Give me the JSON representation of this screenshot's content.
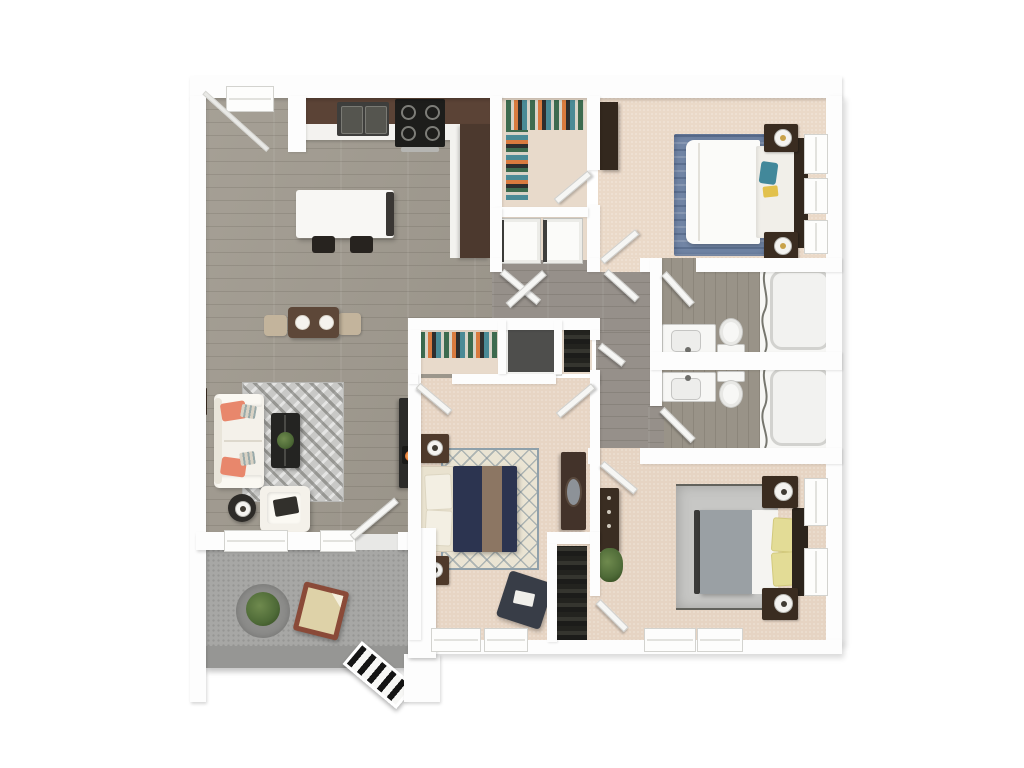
{
  "scene": {
    "type": "3d-floorplan-top-down-render",
    "description": "Top-down 3D rendering of an apartment floor plan on a plain white background. Open living/dining/kitchen with gray plank flooring, walk-in closet and laundry nook, three carpeted bedrooms, two mirrored bathrooms, and a concrete patio with exterior stairs.",
    "background": "plain white, no text or labels visible"
  },
  "rooms": [
    {
      "name": "entry",
      "features": [
        "entry-door",
        "sidelight-window"
      ]
    },
    {
      "name": "kitchen",
      "features": [
        "l-shaped-dark-brown-counter",
        "double-basin-sink",
        "black-stove-with-burners",
        "white-island",
        "two-bar-stools",
        "tall-cabinet-run"
      ]
    },
    {
      "name": "living-dining-area",
      "features": [
        "white-sofa-with-coral-pillows",
        "chevron-area-rug",
        "dark-coffee-table-with-plant",
        "round-side-table-with-lamp",
        "white-armchair-with-tray",
        "media-console-with-fireplace",
        "picture-frame",
        "dining-table-with-two-plates",
        "two-tan-dining-chairs",
        "two-windows"
      ]
    },
    {
      "name": "walk-in-closet",
      "features": [
        "hanging-clothes",
        "door-to-bedroom-1"
      ]
    },
    {
      "name": "laundry-nook",
      "features": [
        "washer",
        "dryer",
        "double-doors-to-hallway"
      ]
    },
    {
      "name": "bedroom-1",
      "features": [
        "white-bed",
        "blue-area-rug",
        "dark-headboard",
        "two-nightstands-with-lamps",
        "teal-and-yellow-accent-pillows",
        "wardrobe",
        "three-windows"
      ]
    },
    {
      "name": "hallway",
      "features": [
        "open-doors",
        "linen-closet-dark",
        "coat-closet-clothes",
        "small-closet-door"
      ]
    },
    {
      "name": "bathroom-upper",
      "features": [
        "vanity-with-sink",
        "toilet",
        "bathtub",
        "shower-curtain",
        "door"
      ]
    },
    {
      "name": "bathroom-lower",
      "features": [
        "vanity-with-sink",
        "toilet",
        "bathtub",
        "shower-curtain",
        "door"
      ]
    },
    {
      "name": "bedroom-2",
      "features": [
        "navy-bed-with-taupe-throw",
        "cream-headboard-with-pillows",
        "diamond-lattice-rug",
        "two-nightstands-with-lamps",
        "dresser-with-oval-mirror",
        "navy-ottoman-with-book",
        "closet-with-clothes-row",
        "two-windows"
      ]
    },
    {
      "name": "bedroom-3",
      "features": [
        "gray-and-white-bed-with-yellow-pillows",
        "gray-bordered-rug",
        "dark-headboard",
        "two-nightstands-with-lamps",
        "dresser",
        "floor-plant",
        "reach-in-closet-dark-clothes",
        "four-windows"
      ]
    },
    {
      "name": "patio",
      "features": [
        "round-gray-rug",
        "potted-plant",
        "wood-frame-lounge-chair",
        "concrete-parapet",
        "exterior-stairs",
        "landing"
      ]
    }
  ],
  "colors": {
    "page_bg": "#ffffff",
    "wall": "#fdfdfd",
    "wood": "#a19b90",
    "hall_wood": "#96908a",
    "bath_wood": "#999388",
    "carpet1": "#ead9c8",
    "carpet2": "#e7d5c4",
    "carpet3": "#e6d4c3",
    "closet_floor": "#e8dacb",
    "patio": "#a7a7a5",
    "parapet": "#969694",
    "kitchen_brown": "#5b4336",
    "kitchen_brown2": "#4c392e",
    "counter_white": "#f3f2ef",
    "island": "#f8f7f4",
    "appliance_black": "#1d1d1b",
    "sink_dark": "#3e3e3c",
    "sofa": "#f4f1ea",
    "pillow_coral": "#e8876c",
    "pillow_gray": "#d9d2c4",
    "rug_living": "#c9c9c7",
    "coffee_dark": "#242422",
    "plant_green": "#4e6a37",
    "table_brown": "#5d4738",
    "chair_tan": "#c3b49c",
    "tv_dark": "#2b2b29",
    "flame_orange": "#e07030",
    "rug_blue": "#7286a6",
    "duvet_white": "#fbfbf9",
    "headboard_dark": "#33281e",
    "nightstand_dark": "#3a2c20",
    "lamp_warm": "#c9a24a",
    "teal": "#42889a",
    "yellow": "#e2c14c",
    "fixture_white": "#f7f7f5",
    "fixture_edge": "#c9c9c6",
    "curtain_gray": "#77776f",
    "rug_cream": "#eae4d3",
    "lattice_blue": "#8fa0aa",
    "navy": "#2c3450",
    "stripe_taupe": "#8c7663",
    "headboard_cream": "#e9e2cf",
    "ns_brown": "#4f3a2b",
    "dresser_brown": "#43332a",
    "mirror_gray": "#8d9298",
    "ottoman_navy": "#383d47",
    "rug_gray": "#c7c7c5",
    "blanket_gray": "#9aa0a4",
    "pillow_yellow": "#e3dc96",
    "chair_frame": "#8a4a38",
    "chair_cushion": "#ded2a8",
    "stair_dark": "#141414",
    "door_white": "#f6f6f4",
    "window_white": "#fdfdfc",
    "clothes1": "#3d6b4f",
    "clothes2": "#d97b3f",
    "clothes3": "#4a8a96",
    "clothes4": "#2e2e2e",
    "clothes5": "#d8d3c8"
  }
}
